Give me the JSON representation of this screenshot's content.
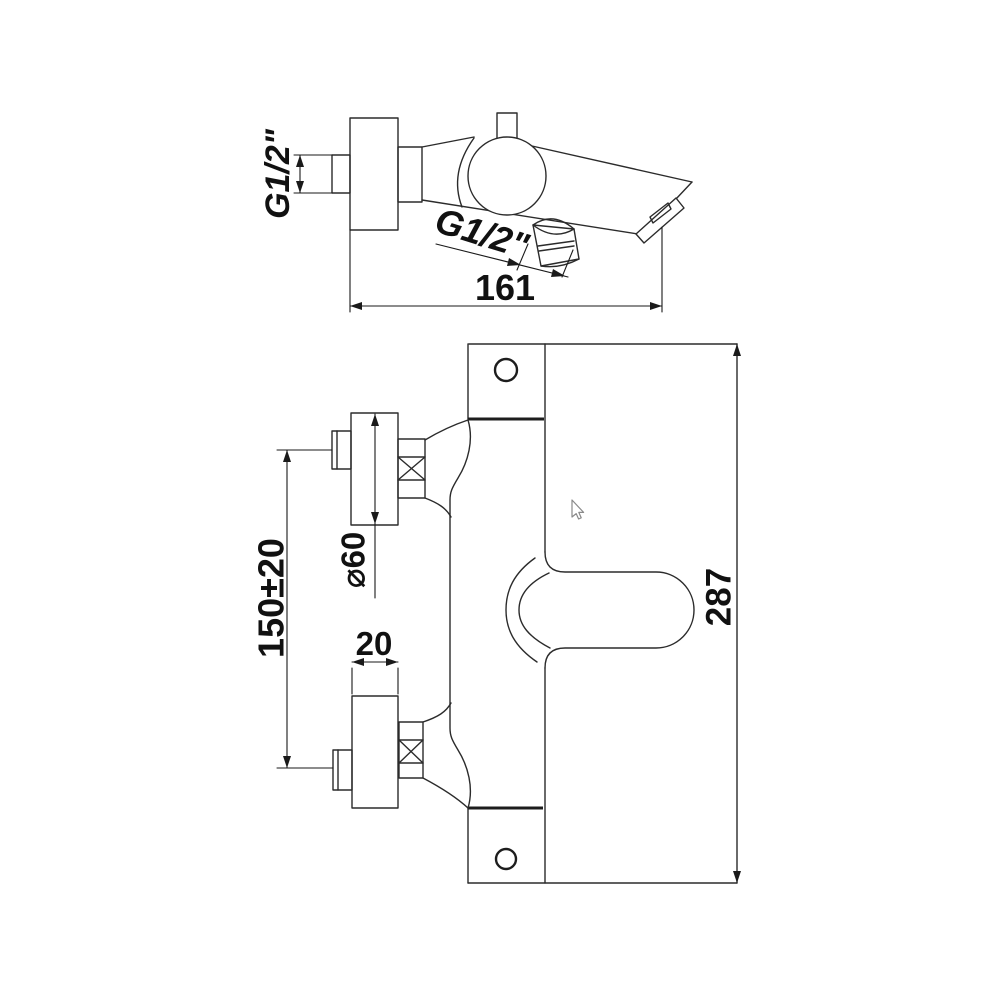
{
  "drawing": {
    "background": "#ffffff",
    "line_color": "#2b2b2b",
    "dim_color": "#1a1a1a",
    "text_color": "#111111",
    "description": "Technical dimension drawing of a wall-mounted bath shower mixer tap, side view and front view"
  },
  "top_view": {
    "inlet_thread_label": "G1/2\"",
    "spout_thread_label": "G1/2\"",
    "width_dim": "161"
  },
  "front_view": {
    "height_dim": "287",
    "inlet_spacing_dim": "150±20",
    "flange_diameter_dim": "⌀60",
    "flange_thickness_dim": "20"
  },
  "cursor": {
    "icon": "mouse-pointer"
  }
}
